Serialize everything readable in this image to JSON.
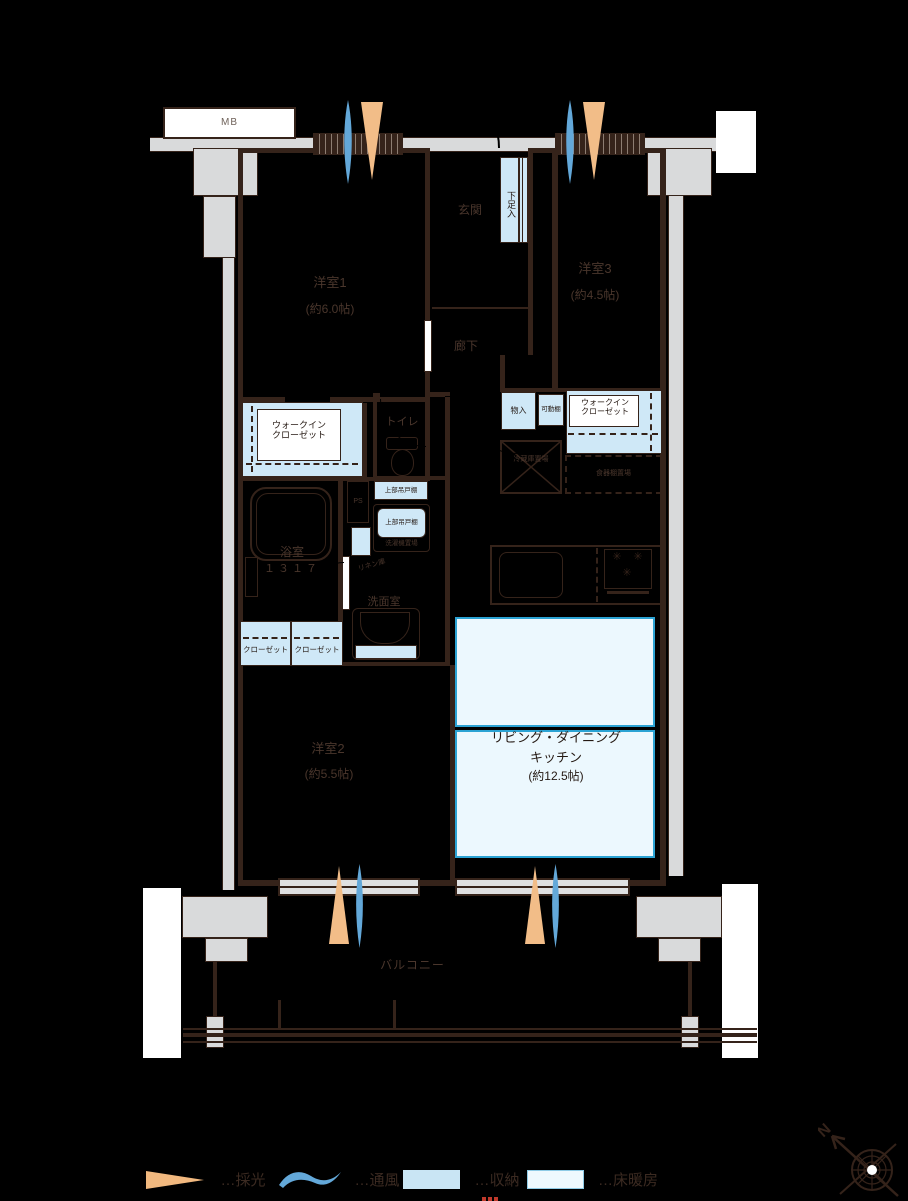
{
  "plan": {
    "rooms": {
      "yoshitsu1": {
        "name": "洋室1",
        "size": "(約6.0帖)"
      },
      "yoshitsu2": {
        "name": "洋室2",
        "size": "(約5.5帖)"
      },
      "yoshitsu3": {
        "name": "洋室3",
        "size": "(約4.5帖)"
      },
      "ldk": {
        "name_line1": "リビング・ダイニング",
        "name_line2": "キッチン",
        "size": "(約12.5帖)"
      },
      "genkan": "玄関",
      "rouka": "廊下",
      "toilet": "トイレ",
      "bathroom": {
        "name": "浴室",
        "size": "１３１７"
      },
      "washroom": "洗面室",
      "balcony": "バルコニー"
    },
    "storage": {
      "shoe_cabinet": "下足入",
      "walk_in_closet_line1": "ウォークイン",
      "walk_in_closet_line2": "クローゼット",
      "closet": "クローゼット",
      "mono_ire": "物入",
      "movable_shelf": "可動棚",
      "linen": "リネン庫",
      "upper_hanging_cabinet": "上部吊戸棚"
    },
    "equipment": {
      "meter_box": "MB",
      "pipe_space": "PS",
      "fridge_space": "冷蔵庫置場",
      "cupboard_space": "食器棚置場",
      "washer_space": "洗濯機置場"
    },
    "compass": {
      "north_label": "N"
    }
  },
  "legend": {
    "daylight": "…採光",
    "ventilation": "…通風",
    "storage": "…収納",
    "floor_heating": "…床暖房"
  },
  "colors": {
    "wall": "#35231a",
    "concrete": "#d9dadb",
    "storage_blue": "#cfe8f7",
    "floor_heating_fill": "#ecf8fe",
    "floor_heating_border": "#2ba3d4",
    "daylight_orange": "#f2bd88",
    "ventilation_blue": "#63a8d9",
    "red_mark": "#c0392b"
  }
}
